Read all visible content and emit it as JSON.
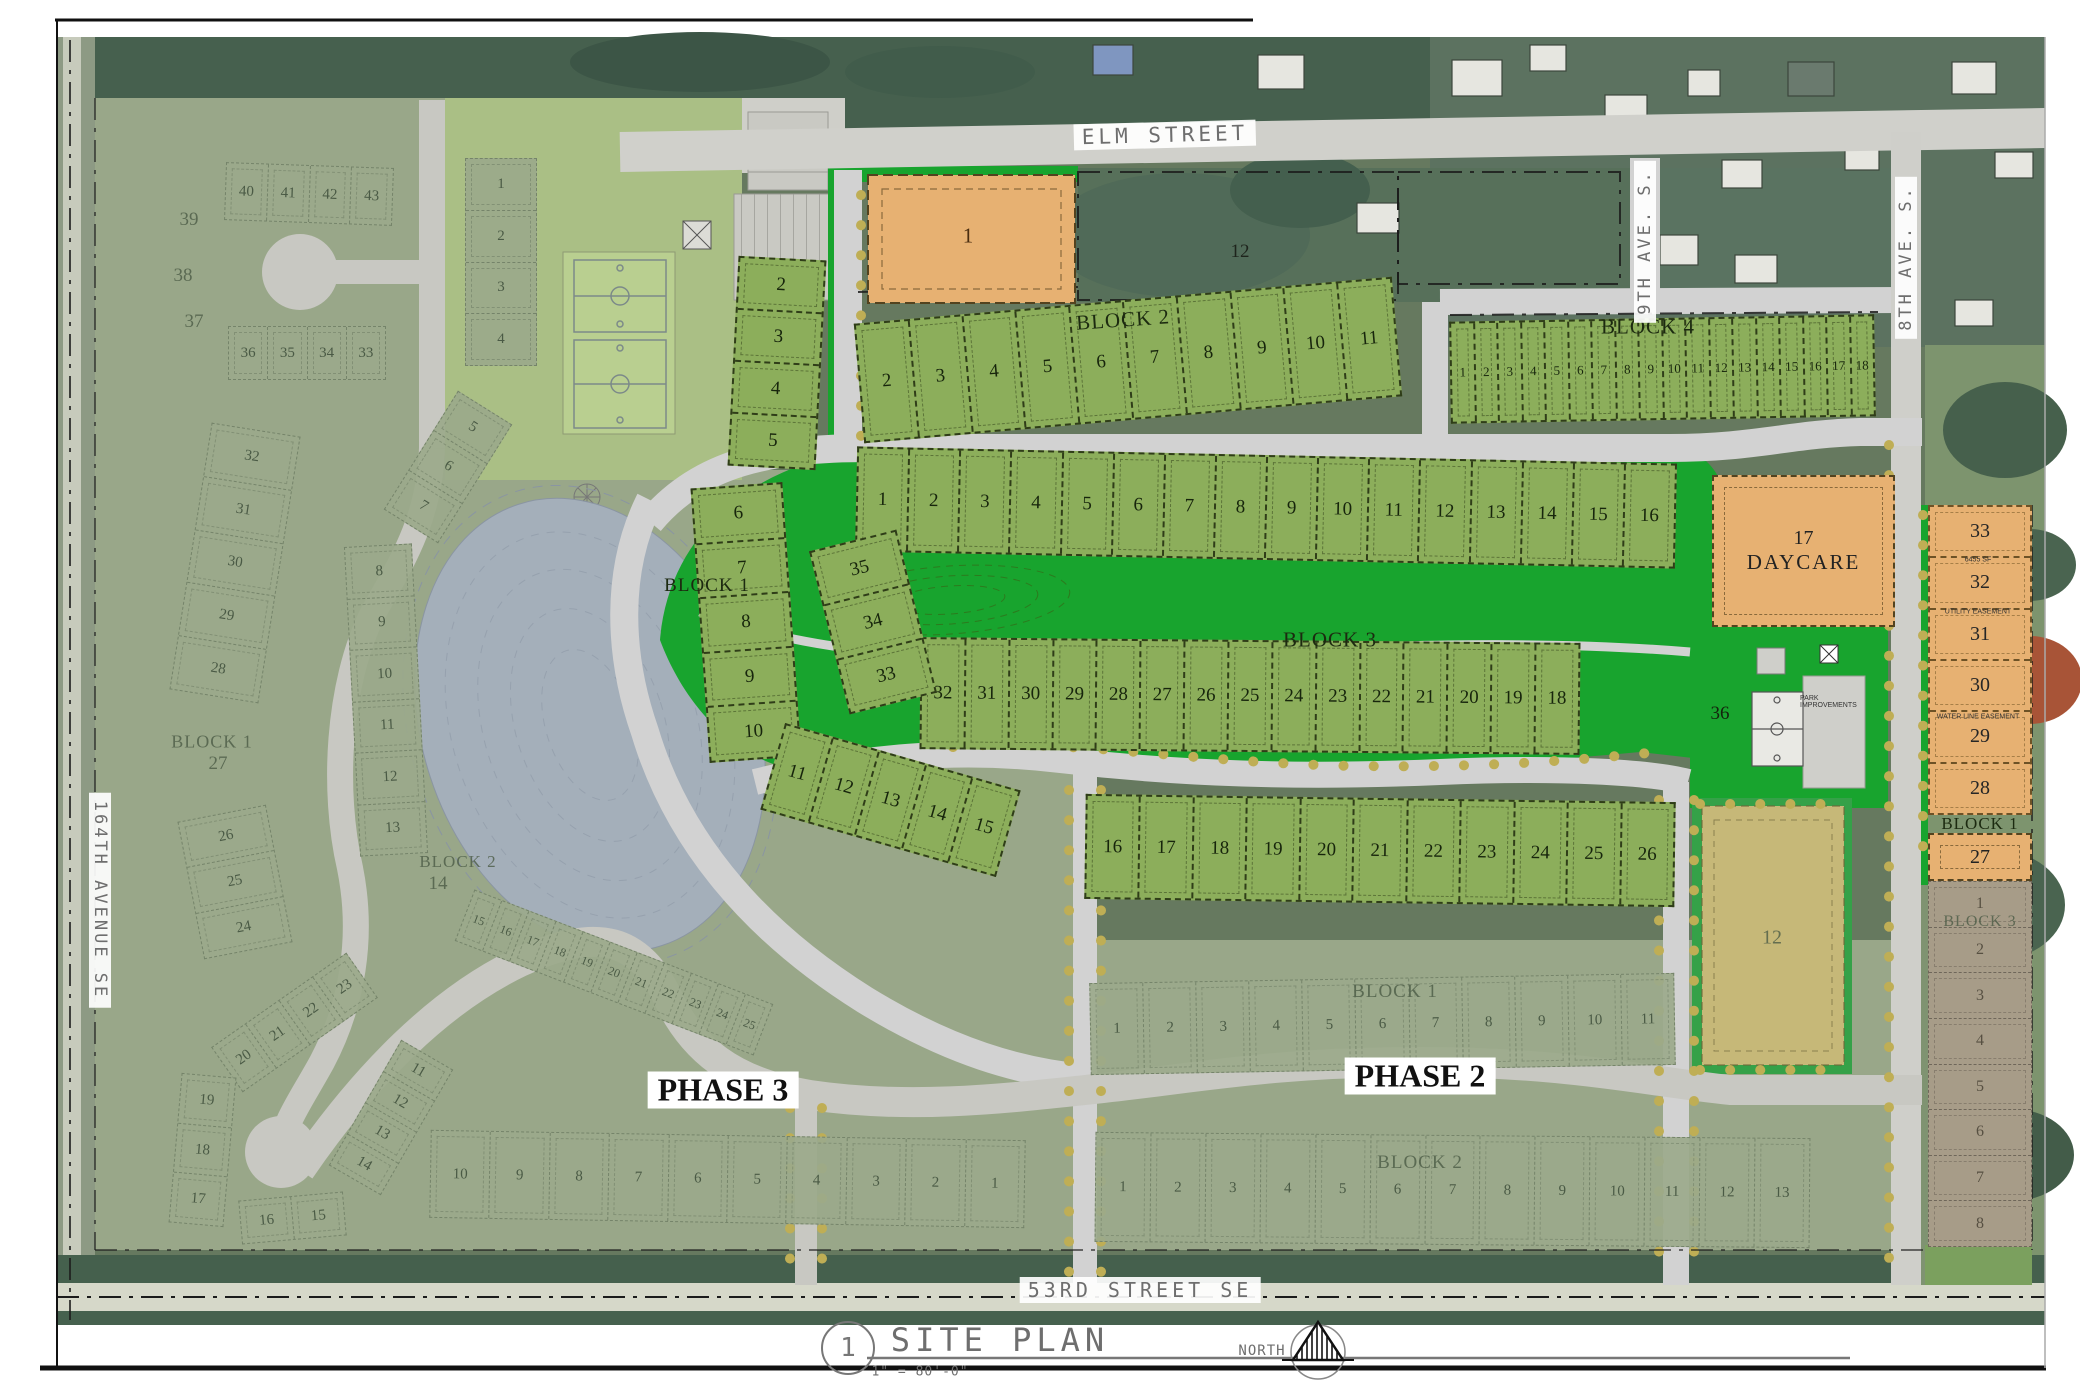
{
  "sheet": {
    "detail_number": "1",
    "title": "SITE PLAN",
    "scale": "1\" = 80'-0\"",
    "north_label": "NORTH"
  },
  "streets": {
    "elm_street": "ELM STREET",
    "ninth_ave": "9TH AVE. S.",
    "eighth_ave": "8TH AVE. S.",
    "ave_164": "164TH AVENUE SE",
    "street_53": "53RD STREET SE"
  },
  "phase_labels": {
    "phase2": "PHASE 2",
    "phase3": "PHASE 3"
  },
  "phase1": {
    "commercial_lot": "1",
    "aerial_parcel": "12",
    "block2": {
      "label": "BLOCK 2",
      "lots": [
        "2",
        "3",
        "4",
        "5",
        "6",
        "7",
        "8",
        "9",
        "10",
        "11"
      ]
    },
    "block4": {
      "label": "BLOCK 4",
      "lots": [
        "1",
        "2",
        "3",
        "4",
        "5",
        "6",
        "7",
        "8",
        "9",
        "10",
        "11",
        "12",
        "13",
        "14",
        "15",
        "16",
        "17",
        "18"
      ]
    },
    "block3": {
      "label": "BLOCK 3",
      "top_lots": [
        "1",
        "2",
        "3",
        "4",
        "5",
        "6",
        "7",
        "8",
        "9",
        "10",
        "11",
        "12",
        "13",
        "14",
        "15",
        "16"
      ],
      "mid_lots": [
        "32",
        "31",
        "30",
        "29",
        "28",
        "27",
        "26",
        "25",
        "24",
        "23",
        "22",
        "21",
        "20",
        "19",
        "18"
      ],
      "west_arc_lots": [
        "35",
        "34",
        "33"
      ],
      "park_lot": "36",
      "daycare_lot": "17",
      "daycare_label": "DAYCARE"
    },
    "block1": {
      "label": "BLOCK 1",
      "arc_top": [
        "2",
        "3",
        "4",
        "5"
      ],
      "arc_mid": [
        "6",
        "7",
        "8",
        "9",
        "10"
      ],
      "arc_low": [
        "11",
        "12",
        "13",
        "14",
        "15"
      ],
      "south_row": [
        "16",
        "17",
        "18",
        "19",
        "20",
        "21",
        "22",
        "23",
        "24",
        "25",
        "26"
      ]
    },
    "east_block1": {
      "label": "BLOCK 1",
      "lots": [
        "33",
        "32",
        "31",
        "30",
        "29",
        "28"
      ],
      "lot27": "27",
      "easement_sf": "6455 SF",
      "easement_utility": "UTILITY EASEMENT",
      "easement_water": "WATER LINE EASEMENT"
    },
    "park": {
      "improvements_label": "PARK IMPROVEMENTS"
    }
  },
  "phase2_area": {
    "block1": {
      "label": "BLOCK 1",
      "lots": [
        "1",
        "2",
        "3",
        "4",
        "5",
        "6",
        "7",
        "8",
        "9",
        "10",
        "11"
      ]
    },
    "block2": {
      "label": "BLOCK 2",
      "lots": [
        "1",
        "2",
        "3",
        "4",
        "5",
        "6",
        "7",
        "8",
        "9",
        "10",
        "11",
        "12",
        "13"
      ]
    },
    "lot12": "12"
  },
  "phase3_area": {
    "block1": {
      "label": "BLOCK 1",
      "lot39": "39",
      "lot38": "38",
      "lot37": "37",
      "cul_row": [
        "40",
        "41",
        "42",
        "43"
      ],
      "row2": [
        "36",
        "35",
        "34",
        "33"
      ],
      "west_col": [
        "32",
        "31",
        "30",
        "29",
        "28"
      ],
      "lot27": "27",
      "south_col": [
        "26",
        "25",
        "24"
      ],
      "ring": [
        "20",
        "21",
        "22",
        "23"
      ],
      "ring2": [
        "19",
        "18",
        "17"
      ],
      "ring3": [
        "16",
        "15"
      ]
    },
    "block2": {
      "label": "BLOCK 2",
      "north_col": [
        "1",
        "2",
        "3",
        "4"
      ],
      "arc": [
        "5",
        "6",
        "7"
      ],
      "west_col": [
        "8",
        "9",
        "10",
        "11",
        "12",
        "13"
      ],
      "lot14": "14",
      "se_row": [
        "15",
        "16",
        "17",
        "18",
        "19",
        "20",
        "21",
        "22",
        "23",
        "24",
        "25"
      ]
    },
    "south_block": {
      "arc": [
        "11",
        "12",
        "13",
        "14"
      ],
      "row": [
        "10",
        "9",
        "8",
        "7",
        "6",
        "5",
        "4",
        "3",
        "2",
        "1"
      ]
    }
  },
  "east_block3": {
    "label": "BLOCK 3",
    "lots": [
      "1",
      "2",
      "3",
      "4",
      "5",
      "6",
      "7",
      "8"
    ]
  },
  "colors": {
    "bright_lot": "#8cae5b",
    "open_green": "#18a42e",
    "faded_lot": "#9aa98a",
    "orange": "#e7b172",
    "tan": "#c6b878",
    "pond": "#a2aeb8",
    "street": "#d2d2d2"
  }
}
